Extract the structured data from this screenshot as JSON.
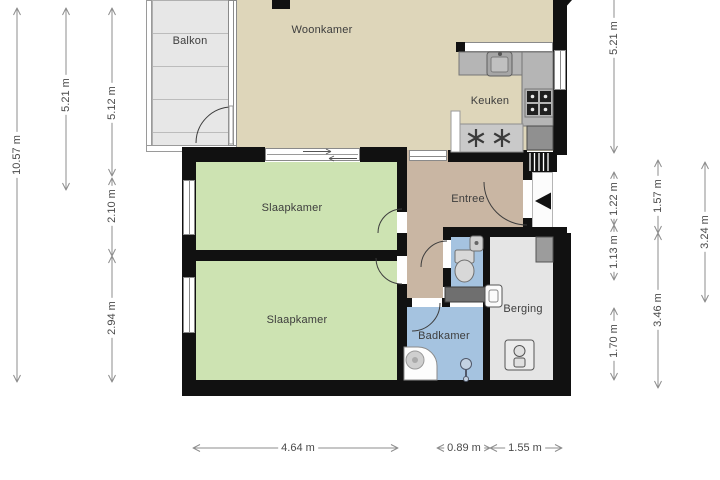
{
  "plan": {
    "title": "apartment-floor-plan",
    "rooms": [
      {
        "id": "woonkamer",
        "label": "Woonkamer"
      },
      {
        "id": "balkon",
        "label": "Balkon"
      },
      {
        "id": "keuken",
        "label": "Keuken"
      },
      {
        "id": "entree",
        "label": "Entree"
      },
      {
        "id": "slaapkamer1",
        "label": "Slaapkamer"
      },
      {
        "id": "slaapkamer2",
        "label": "Slaapkamer"
      },
      {
        "id": "badkamer",
        "label": "Badkamer"
      },
      {
        "id": "berging",
        "label": "Berging"
      }
    ],
    "dimensions": {
      "left": [
        {
          "label": "10.57 m"
        },
        {
          "label": "5.21 m"
        },
        {
          "label": "5.12 m"
        },
        {
          "label": "2.10 m"
        },
        {
          "label": "2.94 m"
        }
      ],
      "right": [
        {
          "label": "5.21 m"
        },
        {
          "label": "1.22 m"
        },
        {
          "label": "1.13 m"
        },
        {
          "label": "1.70 m"
        },
        {
          "label": "1.57 m"
        },
        {
          "label": "3.46 m"
        },
        {
          "label": "3.24 m"
        }
      ],
      "bottom": [
        {
          "label": "4.64 m"
        },
        {
          "label": "0.89 m"
        },
        {
          "label": "1.55 m"
        }
      ]
    },
    "colors": {
      "wall": "#111111",
      "living": "#ded6ba",
      "bedroom": "#cde3b2",
      "bath": "#a5c3e0",
      "entry": "#c9b6a3",
      "storage": "#e5e5e5",
      "balcony": "#e7e7e7",
      "counter": "#b5b5b5",
      "dim_line": "#8c8c8c",
      "label_text": "#3d3d3d"
    },
    "fixtures": [
      "kitchen-sink",
      "stove",
      "fridge",
      "ventilation-fans",
      "toilet",
      "hand-basin",
      "bathroom-cabinet",
      "shower",
      "shower-column",
      "washing-machine",
      "boiler",
      "storage-closet",
      "entrance-arrow",
      "stairs"
    ]
  }
}
